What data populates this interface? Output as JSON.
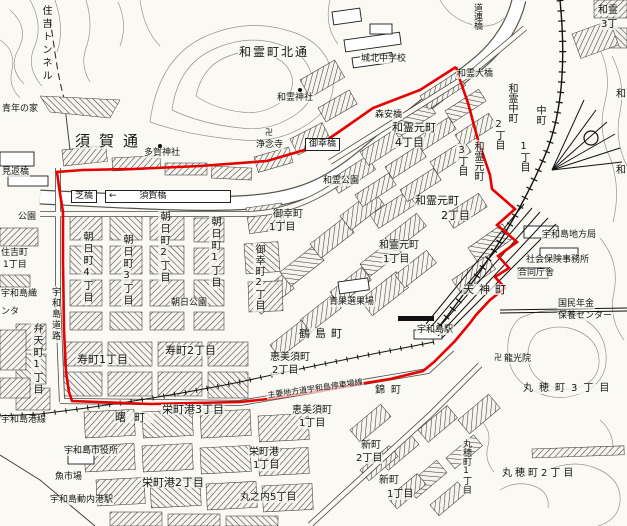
{
  "map": {
    "boundary_color": "#e60000",
    "boundary_points": "456,67 420,90 373,108 343,129 318,146 267,161 200,166 133,169 83,170 57,172 59,187 63,212 63,263 64,330 66,372 69,392 72,401 150,404 240,402 268,399 307,393 335,388 390,379 423,371 434,362 455,341 470,323 476,315 490,300 505,288 495,277 509,268 498,256 517,242 497,225 515,209 492,189 490,175 478,140 468,103 460,80 456,67",
    "labels": [
      {
        "t": "住吉トンネル",
        "x": 40,
        "y": 4,
        "o": "v",
        "fs": 10,
        "ls": 3
      },
      {
        "t": "青年の家",
        "x": 1,
        "y": 105,
        "fs": 9
      },
      {
        "t": "見返橋",
        "x": 1,
        "y": 168,
        "fs": 9
      },
      {
        "t": "須賀通",
        "x": 74,
        "y": 134,
        "fs": 15,
        "ls": 9
      },
      {
        "t": "多賀神社",
        "x": 143,
        "y": 149,
        "fs": 9
      },
      {
        "t": "浄念寺",
        "x": 255,
        "y": 141,
        "fs": 9
      },
      {
        "t": "卍",
        "x": 264,
        "y": 129,
        "fs": 8
      },
      {
        "t": "和霊町北通",
        "x": 238,
        "y": 46,
        "fs": 12,
        "ls": 2
      },
      {
        "t": "和霊神社",
        "x": 276,
        "y": 94,
        "fs": 9
      },
      {
        "t": "城北中学校",
        "x": 360,
        "y": 55,
        "fs": 9
      },
      {
        "t": "和霊大橋",
        "x": 456,
        "y": 70,
        "fs": 9
      },
      {
        "t": "道連橋",
        "x": 472,
        "y": 2,
        "o": "v",
        "fs": 9
      },
      {
        "t": "和霊",
        "x": 597,
        "y": 6,
        "fs": 10
      },
      {
        "t": "3丁",
        "x": 600,
        "y": 20,
        "fs": 10
      },
      {
        "t": "芝橋",
        "x": 71,
        "y": 190,
        "fs": 9,
        "b": 1
      },
      {
        "t": "←        須賀橋",
        "x": 105,
        "y": 190,
        "fs": 9,
        "b": 1,
        "w": 118
      },
      {
        "t": "御幸橋",
        "x": 305,
        "y": 138,
        "fs": 9,
        "b": 1
      },
      {
        "t": "森安橋",
        "x": 374,
        "y": 111,
        "fs": 9
      },
      {
        "t": "和霊公園",
        "x": 322,
        "y": 177,
        "fs": 9
      },
      {
        "t": "和霊元町",
        "x": 391,
        "y": 122,
        "fs": 11
      },
      {
        "t": "4丁目",
        "x": 394,
        "y": 137,
        "fs": 11
      },
      {
        "t": "和霊元町",
        "x": 472,
        "y": 140,
        "o": "v",
        "fs": 10
      },
      {
        "t": "3丁目",
        "x": 456,
        "y": 144,
        "o": "v",
        "fs": 10
      },
      {
        "t": "和霊中町",
        "x": 506,
        "y": 82,
        "o": "v",
        "fs": 10
      },
      {
        "t": "2丁目",
        "x": 493,
        "y": 118,
        "o": "v",
        "fs": 10
      },
      {
        "t": "中町",
        "x": 534,
        "y": 104,
        "o": "v",
        "fs": 10
      },
      {
        "t": "1丁目",
        "x": 518,
        "y": 140,
        "o": "v",
        "fs": 10
      },
      {
        "t": "和霊元町",
        "x": 414,
        "y": 195,
        "fs": 11
      },
      {
        "t": "2丁目",
        "x": 440,
        "y": 210,
        "fs": 11
      },
      {
        "t": "和霊元町",
        "x": 378,
        "y": 241,
        "fs": 10
      },
      {
        "t": "1丁目",
        "x": 382,
        "y": 255,
        "fs": 10
      },
      {
        "t": "御幸町",
        "x": 272,
        "y": 210,
        "fs": 10
      },
      {
        "t": "1丁目",
        "x": 268,
        "y": 223,
        "fs": 10
      },
      {
        "t": "御幸町2丁目",
        "x": 253,
        "y": 243,
        "o": "v",
        "fs": 10,
        "ls": 1
      },
      {
        "t": "朝日町4丁目",
        "x": 81,
        "y": 230,
        "o": "v",
        "fs": 10,
        "ls": 2
      },
      {
        "t": "朝日町3丁目",
        "x": 121,
        "y": 233,
        "o": "v",
        "fs": 10,
        "ls": 2
      },
      {
        "t": "朝日町2丁目",
        "x": 158,
        "y": 210,
        "o": "v",
        "fs": 10,
        "ls": 2
      },
      {
        "t": "朝日町1丁目",
        "x": 209,
        "y": 215,
        "o": "v",
        "fs": 10,
        "ls": 2
      },
      {
        "t": "朝日公園",
        "x": 170,
        "y": 299,
        "fs": 9
      },
      {
        "t": "寿町1丁目",
        "x": 76,
        "y": 354,
        "fs": 11
      },
      {
        "t": "寿町2丁目",
        "x": 164,
        "y": 345,
        "fs": 11
      },
      {
        "t": "弁天町1丁目",
        "x": 31,
        "y": 322,
        "o": "v",
        "fs": 10,
        "ls": 2
      },
      {
        "t": "住吉町",
        "x": 0,
        "y": 249,
        "fs": 9
      },
      {
        "t": "1丁目",
        "x": 2,
        "y": 261,
        "fs": 9
      },
      {
        "t": "公園",
        "x": 17,
        "y": 213,
        "fs": 9
      },
      {
        "t": "宇和島織",
        "x": 0,
        "y": 290,
        "fs": 9
      },
      {
        "t": "ンタ",
        "x": 0,
        "y": 308,
        "fs": 9
      },
      {
        "t": "宇和島道路",
        "x": 50,
        "y": 286,
        "o": "v",
        "fs": 9,
        "ls": 2
      },
      {
        "t": "宇和島港線",
        "x": 0,
        "y": 416,
        "fs": 9
      },
      {
        "t": "曙町",
        "x": 114,
        "y": 412,
        "fs": 11,
        "ls": 8
      },
      {
        "t": "栄町港3丁目",
        "x": 161,
        "y": 404,
        "fs": 11
      },
      {
        "t": "栄町港2丁目",
        "x": 141,
        "y": 477,
        "fs": 11
      },
      {
        "t": "栄町港",
        "x": 248,
        "y": 448,
        "fs": 10
      },
      {
        "t": "1丁目",
        "x": 252,
        "y": 461,
        "fs": 10
      },
      {
        "t": "丸之内5丁目",
        "x": 239,
        "y": 493,
        "fs": 10
      },
      {
        "t": "宇和島市役所",
        "x": 63,
        "y": 447,
        "fs": 9
      },
      {
        "t": "魚市場",
        "x": 54,
        "y": 473,
        "fs": 9
      },
      {
        "t": "宇和島動内港駅",
        "x": 49,
        "y": 496,
        "fs": 9
      },
      {
        "t": "恵美須町",
        "x": 269,
        "y": 353,
        "fs": 10
      },
      {
        "t": "2丁目",
        "x": 271,
        "y": 366,
        "fs": 10
      },
      {
        "t": "恵美須町",
        "x": 291,
        "y": 406,
        "fs": 10
      },
      {
        "t": "1丁目",
        "x": 298,
        "y": 419,
        "fs": 10
      },
      {
        "t": "鶴島町",
        "x": 298,
        "y": 328,
        "fs": 11,
        "ls": 5
      },
      {
        "t": "青果選果場",
        "x": 328,
        "y": 298,
        "fs": 9
      },
      {
        "t": "宇和島駅",
        "x": 416,
        "y": 326,
        "fs": 9
      },
      {
        "t": "天神町",
        "x": 462,
        "y": 284,
        "fs": 11,
        "ls": 5
      },
      {
        "t": "主要地方道宇和島停車場線",
        "x": 266,
        "y": 392,
        "fs": 8,
        "r": -8
      },
      {
        "t": "錦町",
        "x": 374,
        "y": 386,
        "fs": 10,
        "ls": 6
      },
      {
        "t": "新町",
        "x": 360,
        "y": 441,
        "fs": 10
      },
      {
        "t": "2丁目",
        "x": 355,
        "y": 454,
        "fs": 10
      },
      {
        "t": "新町",
        "x": 378,
        "y": 476,
        "fs": 10
      },
      {
        "t": "1丁目",
        "x": 386,
        "y": 490,
        "fs": 10
      },
      {
        "t": "丸穂町1丁目",
        "x": 461,
        "y": 438,
        "o": "v",
        "fs": 9
      },
      {
        "t": "丸穂町2丁目",
        "x": 501,
        "y": 469,
        "fs": 10,
        "ls": 3
      },
      {
        "t": "丸穂町3丁目",
        "x": 522,
        "y": 384,
        "fs": 10,
        "ls": 6
      },
      {
        "t": "龍光院",
        "x": 503,
        "y": 355,
        "fs": 9
      },
      {
        "t": "卍",
        "x": 493,
        "y": 354,
        "fs": 8
      },
      {
        "t": "宇和島地方局",
        "x": 541,
        "y": 231,
        "fs": 9
      },
      {
        "t": "社会保険事務所",
        "x": 525,
        "y": 256,
        "fs": 9
      },
      {
        "t": "合同庁舎",
        "x": 517,
        "y": 269,
        "fs": 9
      },
      {
        "t": "国民年金",
        "x": 557,
        "y": 300,
        "fs": 9
      },
      {
        "t": "保養センター",
        "x": 557,
        "y": 312,
        "fs": 9
      },
      {
        "t": "和",
        "x": 615,
        "y": 90,
        "fs": 10
      },
      {
        "t": "和",
        "x": 615,
        "y": 166,
        "fs": 10
      }
    ]
  }
}
